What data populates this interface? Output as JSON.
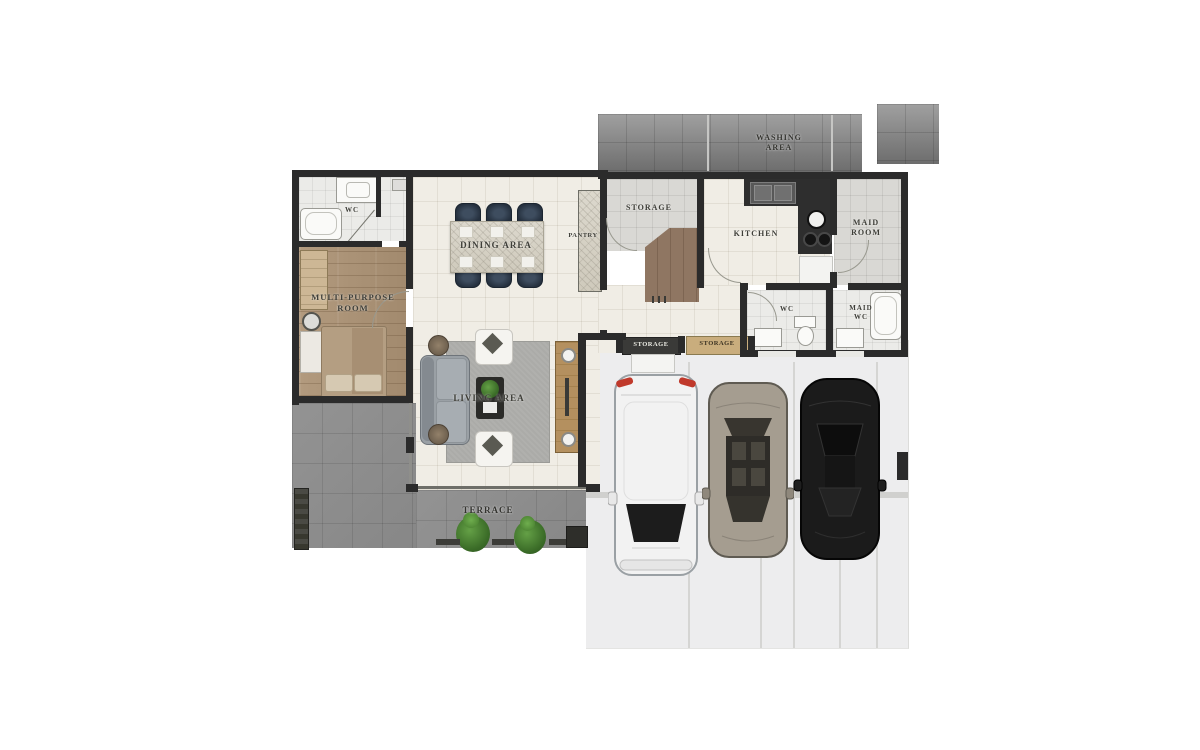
{
  "floor_plan": {
    "labels": {
      "washing_area": "WASHING AREA",
      "storage_room": "STORAGE",
      "kitchen": "KITCHEN",
      "maid_room": "MAID ROOM",
      "pantry": "PANTRY",
      "wc_main": "WC",
      "multi_purpose_room": "MULTI-PURPOSE ROOM",
      "dining_area": "DINING AREA",
      "living_area": "LIVING AREA",
      "storage_cabinet_left": "STORAGE",
      "storage_cabinet_right": "STORAGE",
      "wc_service": "WC",
      "maid_wc": "MAID WC",
      "terrace": "TERRACE"
    },
    "colors": {
      "wall": "#2b2b2b",
      "cream_floor": "#f0ede5",
      "wood_floor": "#ab9277",
      "terrace_floor": "#8f8f8f",
      "garage_floor": "#ededee",
      "washing_floor": "#8a8a8a",
      "dining_chair": "#2c3947",
      "storage_cabinet_tan": "#c9ad7d",
      "taillight_red": "#c0392b"
    },
    "garage": {
      "cars": [
        {
          "id": "white-suv",
          "body_color": "#f2f2f2",
          "glass_color": "#1c1c1c"
        },
        {
          "id": "tan-sedan",
          "body_color": "#a59d90",
          "glass_color": "#2e2c28"
        },
        {
          "id": "black-coupe",
          "body_color": "#1b1b1b",
          "glass_color": "#0d0d0d"
        }
      ]
    }
  }
}
